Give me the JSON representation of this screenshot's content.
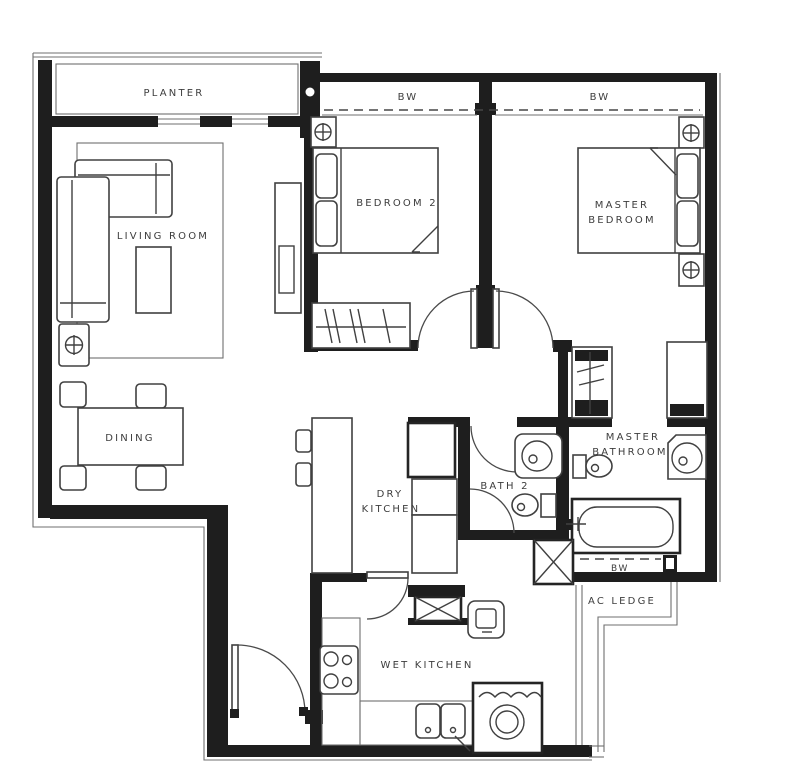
{
  "title": "2-Bedroom Apartment Floor Plan",
  "colors": {
    "background": "#ffffff",
    "wall": "#1e1e1e",
    "fixture_line": "#404040",
    "thin_line": "#6f6f6f",
    "text": "#3d3d3d"
  },
  "rooms": {
    "planter": {
      "label": "PLANTER"
    },
    "living_room": {
      "label": "LIVING ROOM"
    },
    "dining": {
      "label": "DINING"
    },
    "bedroom2": {
      "label": "BEDROOM 2"
    },
    "master_bedroom": {
      "line1": "MASTER",
      "line2": "BEDROOM"
    },
    "dry_kitchen": {
      "line1": "DRY",
      "line2": "KITCHEN"
    },
    "wet_kitchen": {
      "label": "WET KITCHEN"
    },
    "bath2": {
      "label": "BATH 2"
    },
    "master_bathroom": {
      "line1": "MASTER",
      "line2": "BATHROOM"
    },
    "ac_ledge": {
      "label": "AC LEDGE"
    }
  },
  "annotations": {
    "bay_window_bedroom2": "BW",
    "bay_window_master_bedroom": "BW",
    "bay_window_master_bathroom": "BW"
  },
  "fixtures": [
    "l-shaped-sofa",
    "rug",
    "coffee-table",
    "lamp-side-table",
    "tv-console",
    "dining-table",
    "dining-chairs",
    "island-counter",
    "bar-stools",
    "kitchen-cabinets",
    "refrigerator-box",
    "service-shaft",
    "stove-hob",
    "double-sink",
    "washing-machine",
    "counter-appliance",
    "bed-bedroom2",
    "bed-master",
    "bedside-tables",
    "table-lamps",
    "wardrobe-hangers",
    "walk-in-wardrobe",
    "closet",
    "wash-basin-bath2",
    "wash-basin-master",
    "toilet-bath2",
    "toilet-master",
    "bathtub",
    "door-swings",
    "bay-window-dashes",
    "ac-ledge-outline",
    "planter-box"
  ]
}
